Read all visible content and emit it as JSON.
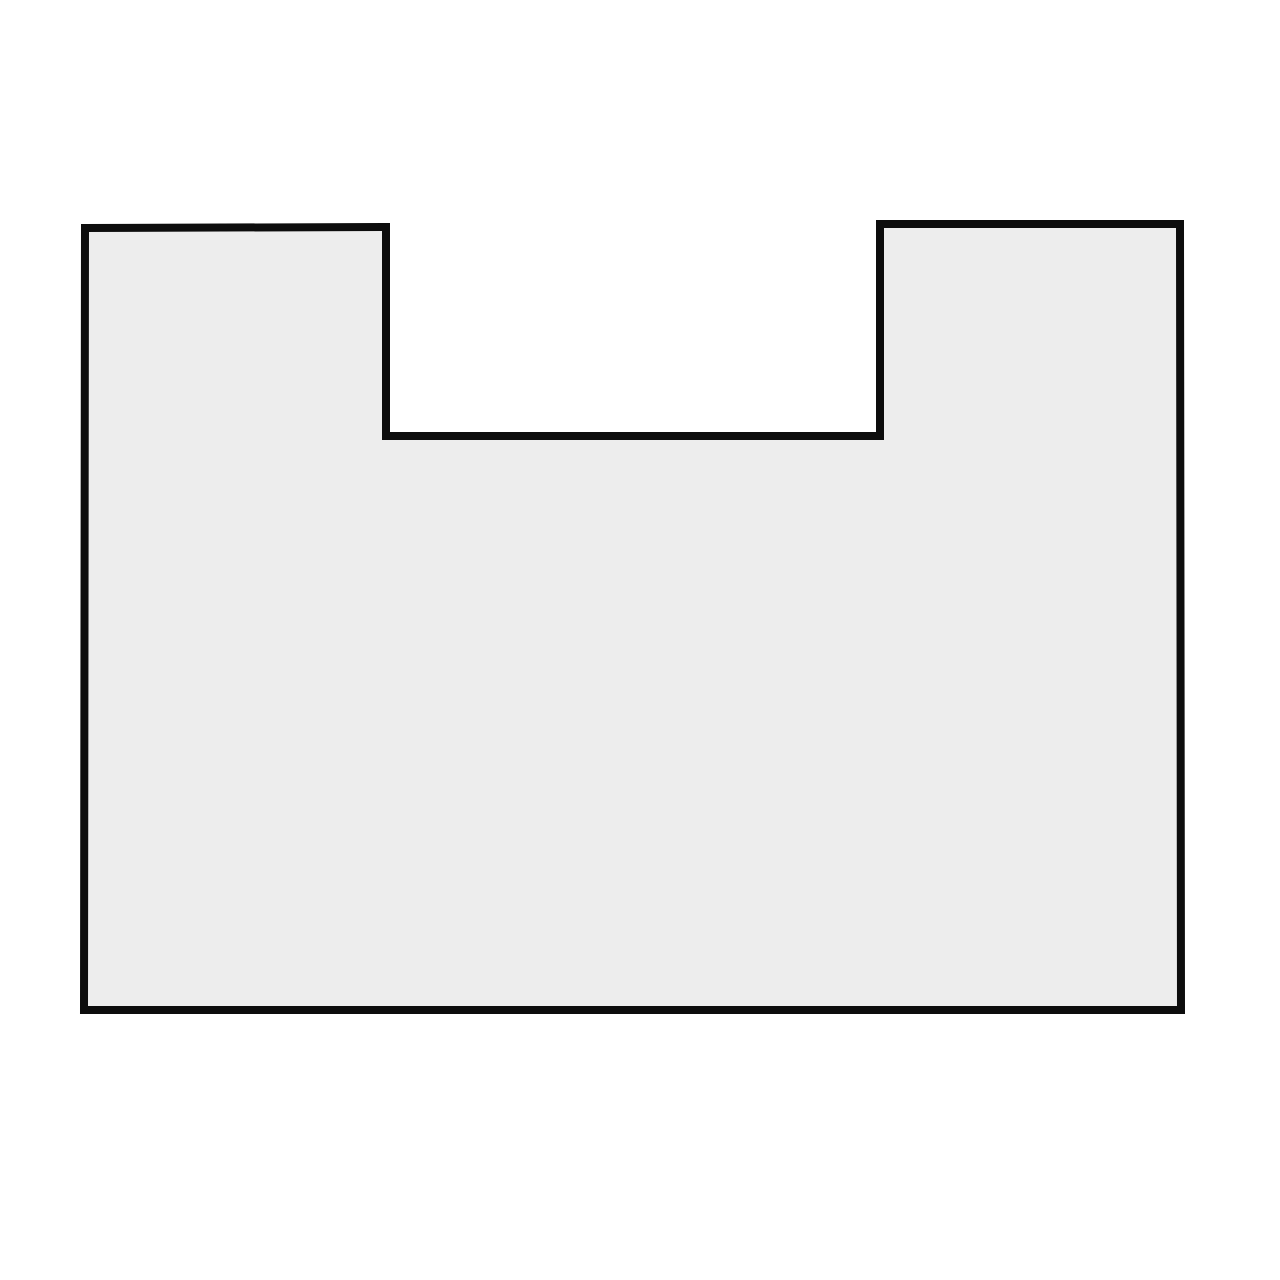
{
  "figure": {
    "kind": "notched-rectangle-diagram",
    "background_color": "#ffffff",
    "shape": {
      "points": "85,228 386,227 386,436 880,436 880,224 1180,224 1181,1010 84,1010",
      "fill": "#ededed",
      "stroke": "#0d0d0d",
      "stroke_width": "8"
    }
  }
}
